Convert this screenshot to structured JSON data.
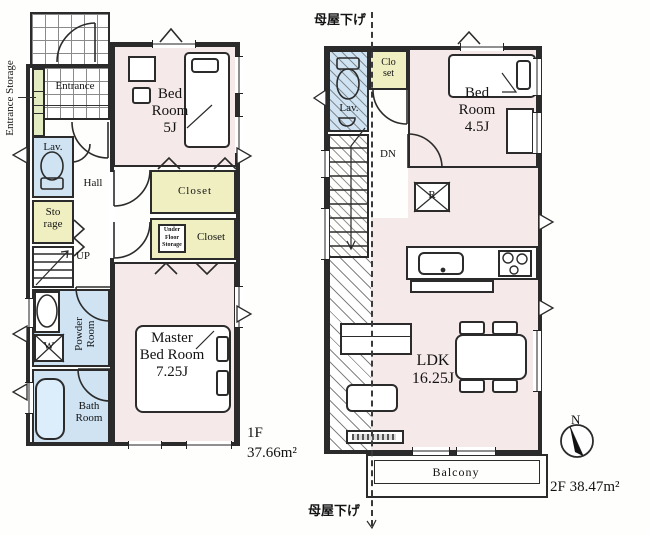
{
  "floor1": {
    "floor_label": "1F",
    "area_label": "37.66m²",
    "rooms": {
      "entrance_storage": "Entrance Storage",
      "entrance": "Entrance",
      "lavatory": "Lav.",
      "hall": "Hall",
      "storage": "Sto\nrage",
      "stairs_up": "UP",
      "powder_room": "Powder\nRoom",
      "washer": "W",
      "bath_room": "Bath\nRoom",
      "bedroom": "Bed\nRoom\n5J",
      "closet_upper": "Closet",
      "under_floor_storage": "Under\nFloor\nStorage",
      "closet_lower": "Closet",
      "master_bedroom": "Master\nBed Room\n7.25J"
    }
  },
  "floor2": {
    "floor_label": "2F",
    "area_label": "38.47m²",
    "rooms": {
      "lavatory": "Lav.",
      "closet": "Clo\nset",
      "bedroom": "Bed\nRoom\n4.5J",
      "stairs_down": "DN",
      "refrigerator": "R",
      "ldk": "LDK\n16.25J",
      "balcony": "Balcony"
    },
    "annotations": {
      "roof_lowered_top": "母屋下げ",
      "roof_lowered_bottom": "母屋下げ"
    },
    "compass_north": "N"
  },
  "colors": {
    "floor_pink": "#f6e9e9",
    "wet_blue": "#cfe3f2",
    "closet_yellow": "#f0efc2",
    "storage_green": "#e3ecc0",
    "wall": "#2b2b2b"
  }
}
